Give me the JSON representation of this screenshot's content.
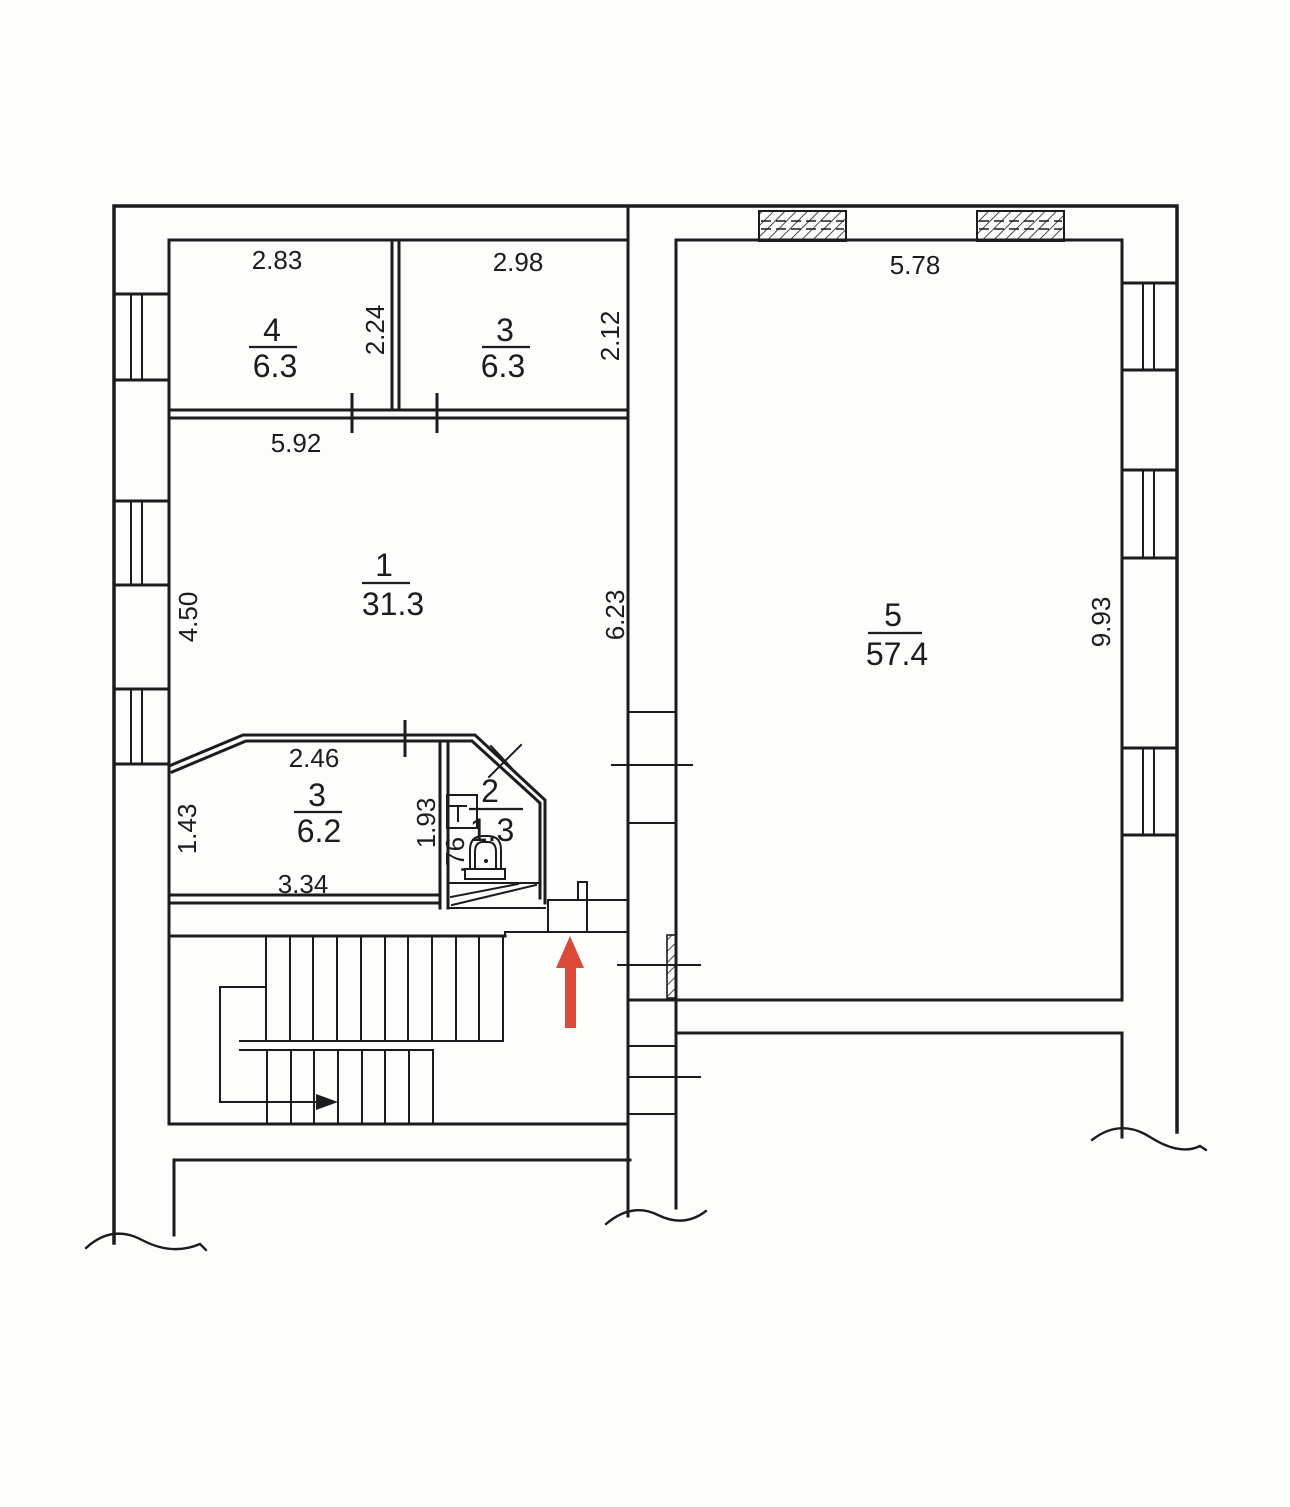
{
  "plan": {
    "rooms": [
      {
        "key": "room-4",
        "number": "4",
        "area": "6.3"
      },
      {
        "key": "room-3-top",
        "number": "3",
        "area": "6.3"
      },
      {
        "key": "room-1",
        "number": "1",
        "area": "31.3"
      },
      {
        "key": "room-3-bottom",
        "number": "3",
        "area": "6.2"
      },
      {
        "key": "room-2",
        "number": "2",
        "area": "1.3"
      },
      {
        "key": "room-5",
        "number": "5",
        "area": "57.4"
      }
    ],
    "dimensions": {
      "room4_top": "2.83",
      "room3top_top": "2.98",
      "room4_right": "2.24",
      "room3top_right": "2.12",
      "room1_top": "5.92",
      "room1_left": "4.50",
      "room1_right": "6.23",
      "room5_top": "5.78",
      "room5_right": "9.93",
      "room3bottom_top": "2.46",
      "room3bottom_left": "1.43",
      "room3bottom_bottom": "3.34",
      "room2_left": "1.93",
      "room2_inner": ".76"
    },
    "colors": {
      "line": "#1c1c1c",
      "entrance_arrow": "#d94b38",
      "paper": "#fdfdfc"
    }
  }
}
